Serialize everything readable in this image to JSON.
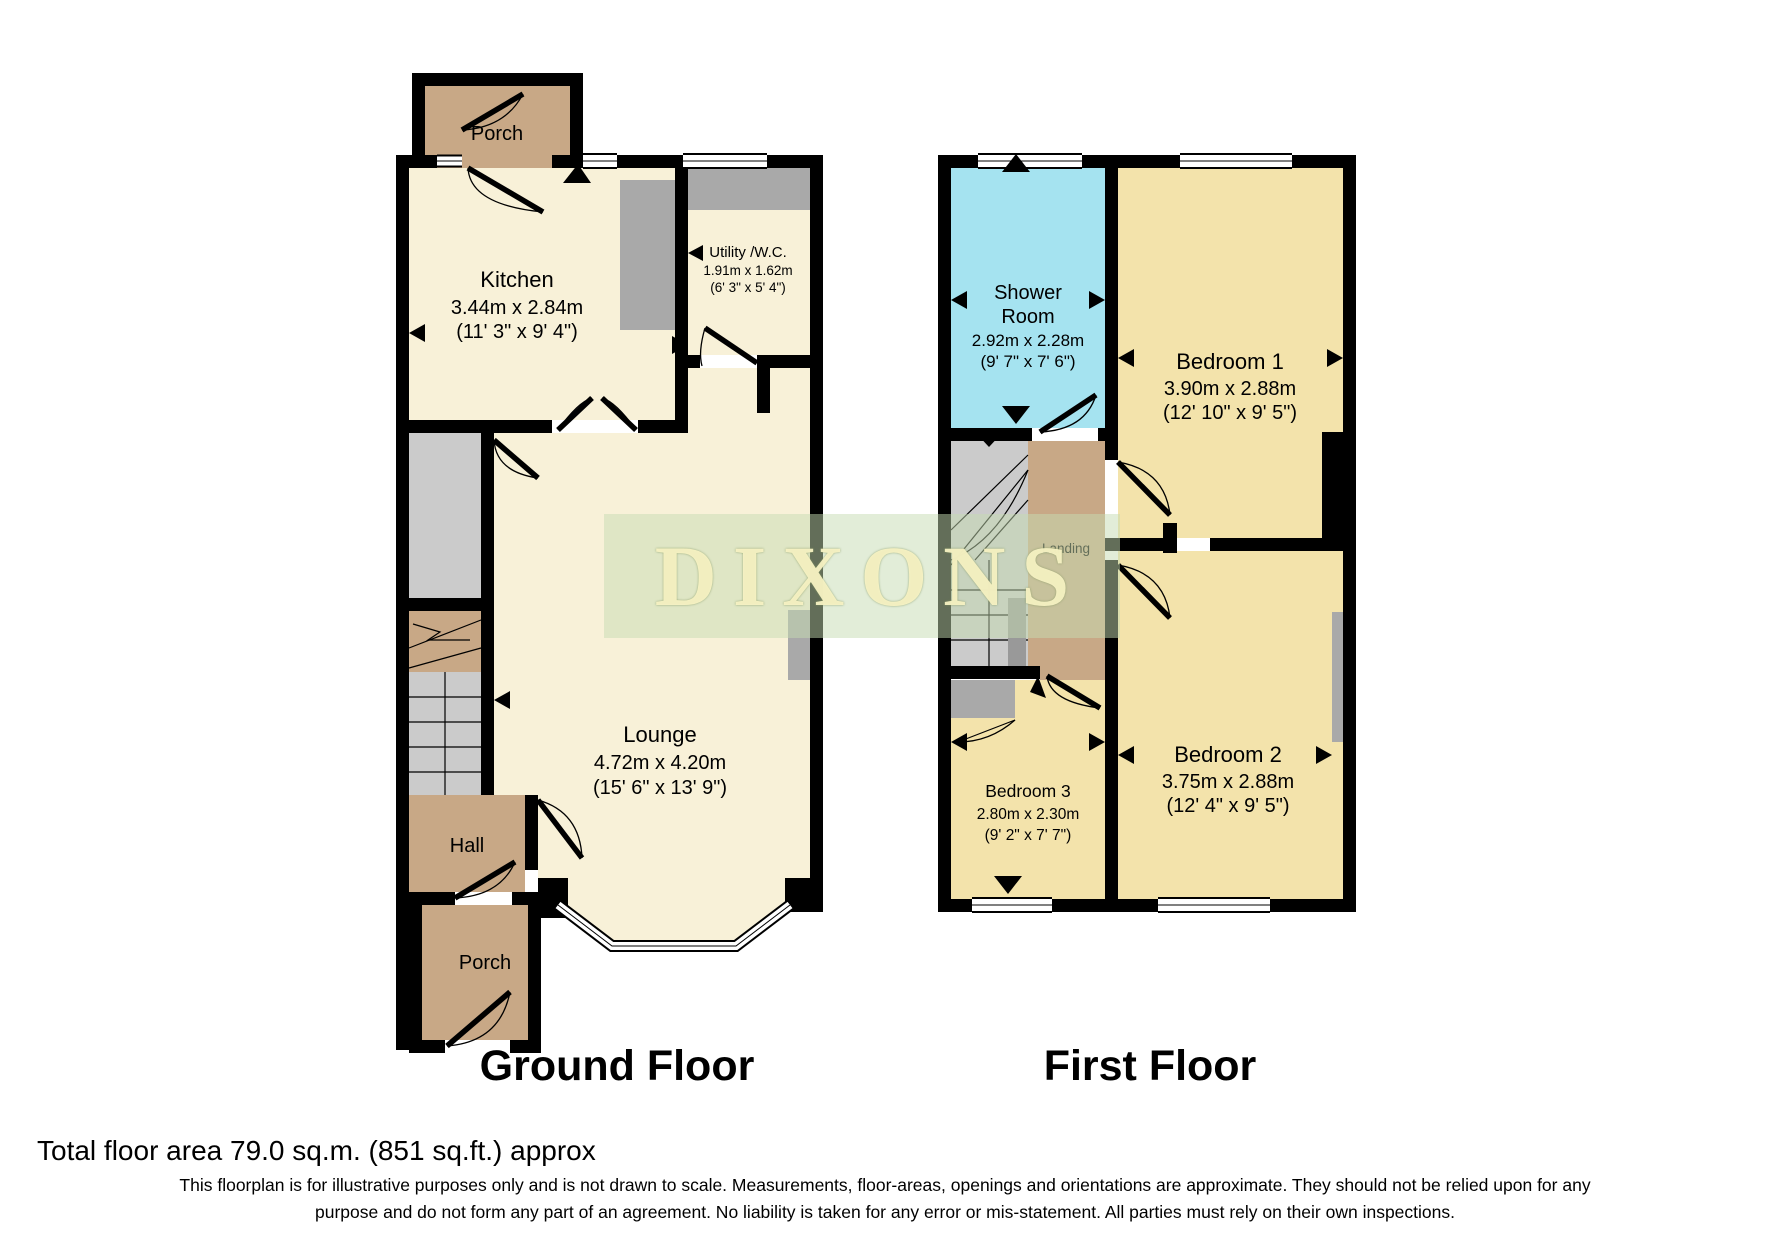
{
  "watermark": "DIXONS",
  "titles": {
    "ground": "Ground Floor",
    "first": "First Floor"
  },
  "ground": {
    "porch_top": "Porch",
    "kitchen": {
      "name": "Kitchen",
      "metric": "3.44m x 2.84m",
      "imperial": "(11' 3\" x 9' 4\")"
    },
    "utility": {
      "name": "Utility /W.C.",
      "metric": "1.91m x 1.62m",
      "imperial": "(6' 3\" x 5' 4\")"
    },
    "lounge": {
      "name": "Lounge",
      "metric": "4.72m x 4.20m",
      "imperial": "(15' 6\" x 13' 9\")"
    },
    "hall": "Hall",
    "porch_bottom": "Porch"
  },
  "first": {
    "shower": {
      "name1": "Shower",
      "name2": "Room",
      "metric": "2.92m x 2.28m",
      "imperial": "(9' 7\" x 7' 6\")"
    },
    "bedroom1": {
      "name": "Bedroom 1",
      "metric": "3.90m x 2.88m",
      "imperial": "(12' 10\" x 9' 5\")"
    },
    "bedroom2": {
      "name": "Bedroom 2",
      "metric": "3.75m x 2.88m",
      "imperial": "(12' 4\" x 9' 5\")"
    },
    "bedroom3": {
      "name": "Bedroom 3",
      "metric": "2.80m x 2.30m",
      "imperial": "(9' 2\" x 7' 7\")"
    },
    "landing": "Landing"
  },
  "footer": {
    "total_area": "Total floor area 79.0 sq.m. (851 sq.ft.) approx",
    "disclaimer1": "This floorplan is for illustrative purposes only and is not drawn to scale. Measurements, floor-areas, openings and orientations are approximate. They should not be relied upon for any",
    "disclaimer2": "purpose and do not form any part of an agreement. No liability is taken for any error or mis-statement. All parties must rely on their own inspections."
  },
  "colors": {
    "wall": "#000000",
    "room_cream": "#f8f1d8",
    "room_yellow": "#f3e3ab",
    "hall_tan": "#c8a886",
    "shower_cyan": "#a5e3f0",
    "fixture_gray": "#a9a9a9",
    "watermark_band": "#c6dcb2",
    "watermark_text": "#faf4c5"
  }
}
